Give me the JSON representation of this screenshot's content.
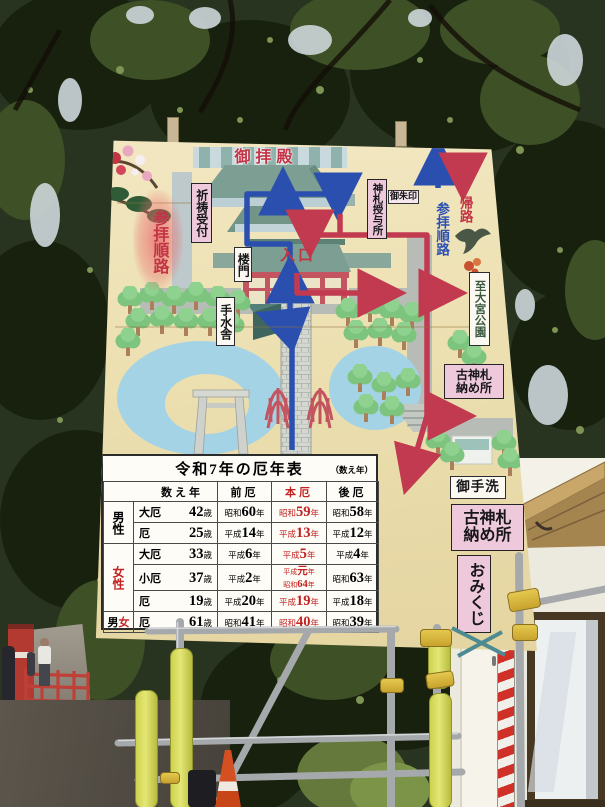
{
  "sign": {
    "map": {
      "main_hall": "御拝殿",
      "prayer_reception": "祈祷受付",
      "route_label_left": "参拝順路",
      "amulet_office": "神札授与所",
      "goshuin": "御朱印",
      "tower_gate": "楼門",
      "entrance": "入口",
      "water_pavilion": "手水舎",
      "return_label": "帰路",
      "route_label_right": "参拝順路",
      "to_omiya_park": "至大宮公園",
      "old_amulet_line1": "古神札",
      "old_amulet_line2": "納め所",
      "restroom": "御手洗"
    },
    "side_signs": {
      "old_amulet_line1": "古神札",
      "old_amulet_line2": "納め所",
      "omikuji": "おみくじ"
    },
    "table": {
      "title": "令和7年の厄年表",
      "note": "（数え年）",
      "headers": {
        "kazoe": "数え年",
        "mae": "前厄",
        "hon": "本厄",
        "ato": "後厄"
      },
      "group_male": "男性",
      "group_female": "女性",
      "group_both_m": "男",
      "group_both_f": "女",
      "year": "年",
      "sai": "歳",
      "rows": [
        {
          "kind": "大厄",
          "age": "42",
          "mae_era": "昭和",
          "mae_num": "60",
          "hon_era": "昭和",
          "hon_num": "59",
          "ato_era": "昭和",
          "ato_num": "58"
        },
        {
          "kind": "厄",
          "age": "25",
          "mae_era": "平成",
          "mae_num": "14",
          "hon_era": "平成",
          "hon_num": "13",
          "ato_era": "平成",
          "ato_num": "12"
        },
        {
          "kind": "大厄",
          "age": "33",
          "mae_era": "平成",
          "mae_num": "6",
          "hon_era": "平成",
          "hon_num": "5",
          "ato_era": "平成",
          "ato_num": "4"
        },
        {
          "kind": "小厄",
          "age": "37",
          "mae_era": "平成",
          "mae_num": "2",
          "hon1_era": "平成",
          "hon1_num": "元",
          "hon2_era": "昭和",
          "hon2_num": "64",
          "ato_era": "昭和",
          "ato_num": "63"
        },
        {
          "kind": "厄",
          "age": "19",
          "mae_era": "平成",
          "mae_num": "20",
          "hon_era": "平成",
          "hon_num": "19",
          "ato_era": "平成",
          "ato_num": "18"
        },
        {
          "kind": "厄",
          "age": "61",
          "mae_era": "昭和",
          "mae_num": "41",
          "hon_era": "昭和",
          "hon_num": "40",
          "ato_era": "昭和",
          "ato_num": "39"
        }
      ]
    }
  },
  "icons": {
    "bird": "bird-silhouette",
    "plum_blossom": "plum-blossom",
    "pine": "pine-branch",
    "torii": "torii-gate",
    "bridges": "arched-bridge",
    "trees": "round-tree"
  },
  "colors": {
    "route_in_blue": "#2b4fae",
    "route_out_red": "#c23a50",
    "sign_cream": "#ecdfb0",
    "label_pink": "#eec9dc",
    "roof_teal": "#7d9e92",
    "pond_blue": "#a5d3e6",
    "table_red": "#c32222",
    "scaffold_yellow": "#dede5e"
  }
}
